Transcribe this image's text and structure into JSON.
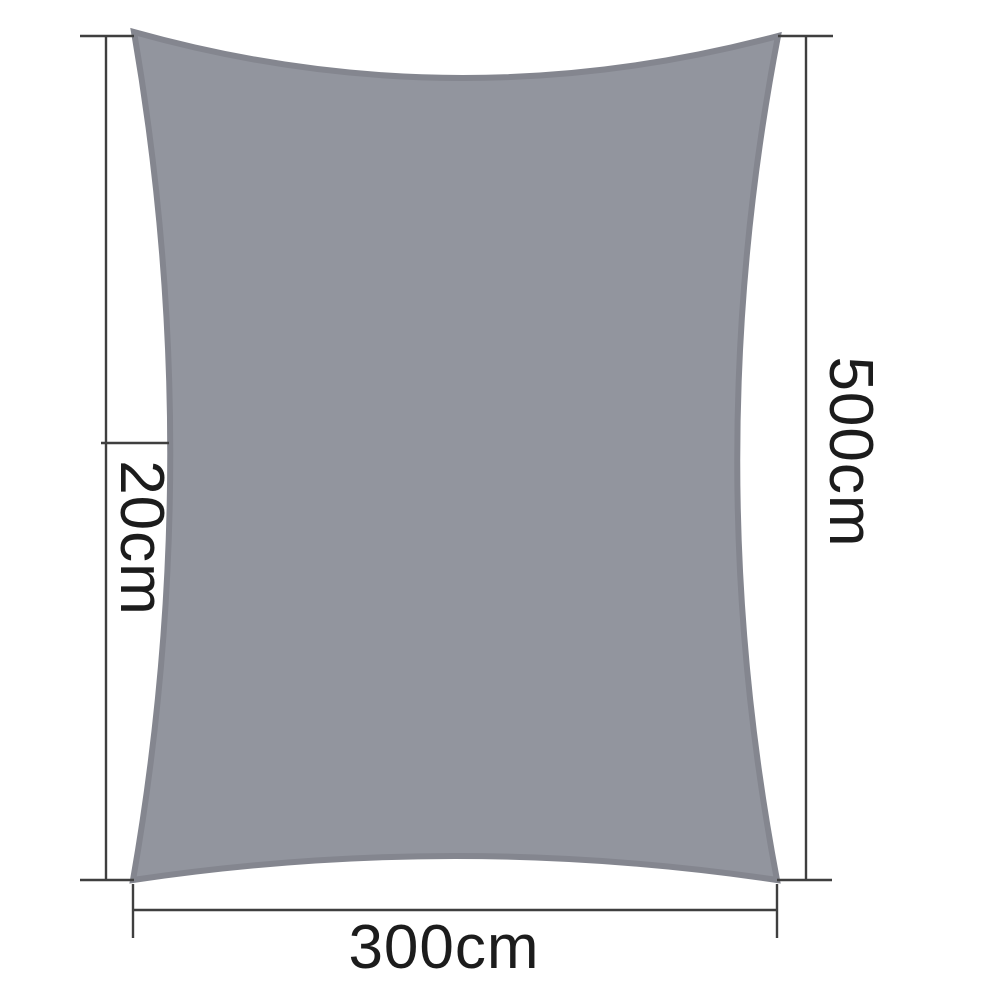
{
  "labels": {
    "curve_depth": "20cm",
    "height": "500cm",
    "width": "300cm"
  },
  "colors": {
    "background": "#ffffff",
    "sail_fill": "#92959e",
    "sail_outline": "#84868f",
    "dimension_line": "#3f3f3f",
    "label_text": "#1c1c1c"
  }
}
